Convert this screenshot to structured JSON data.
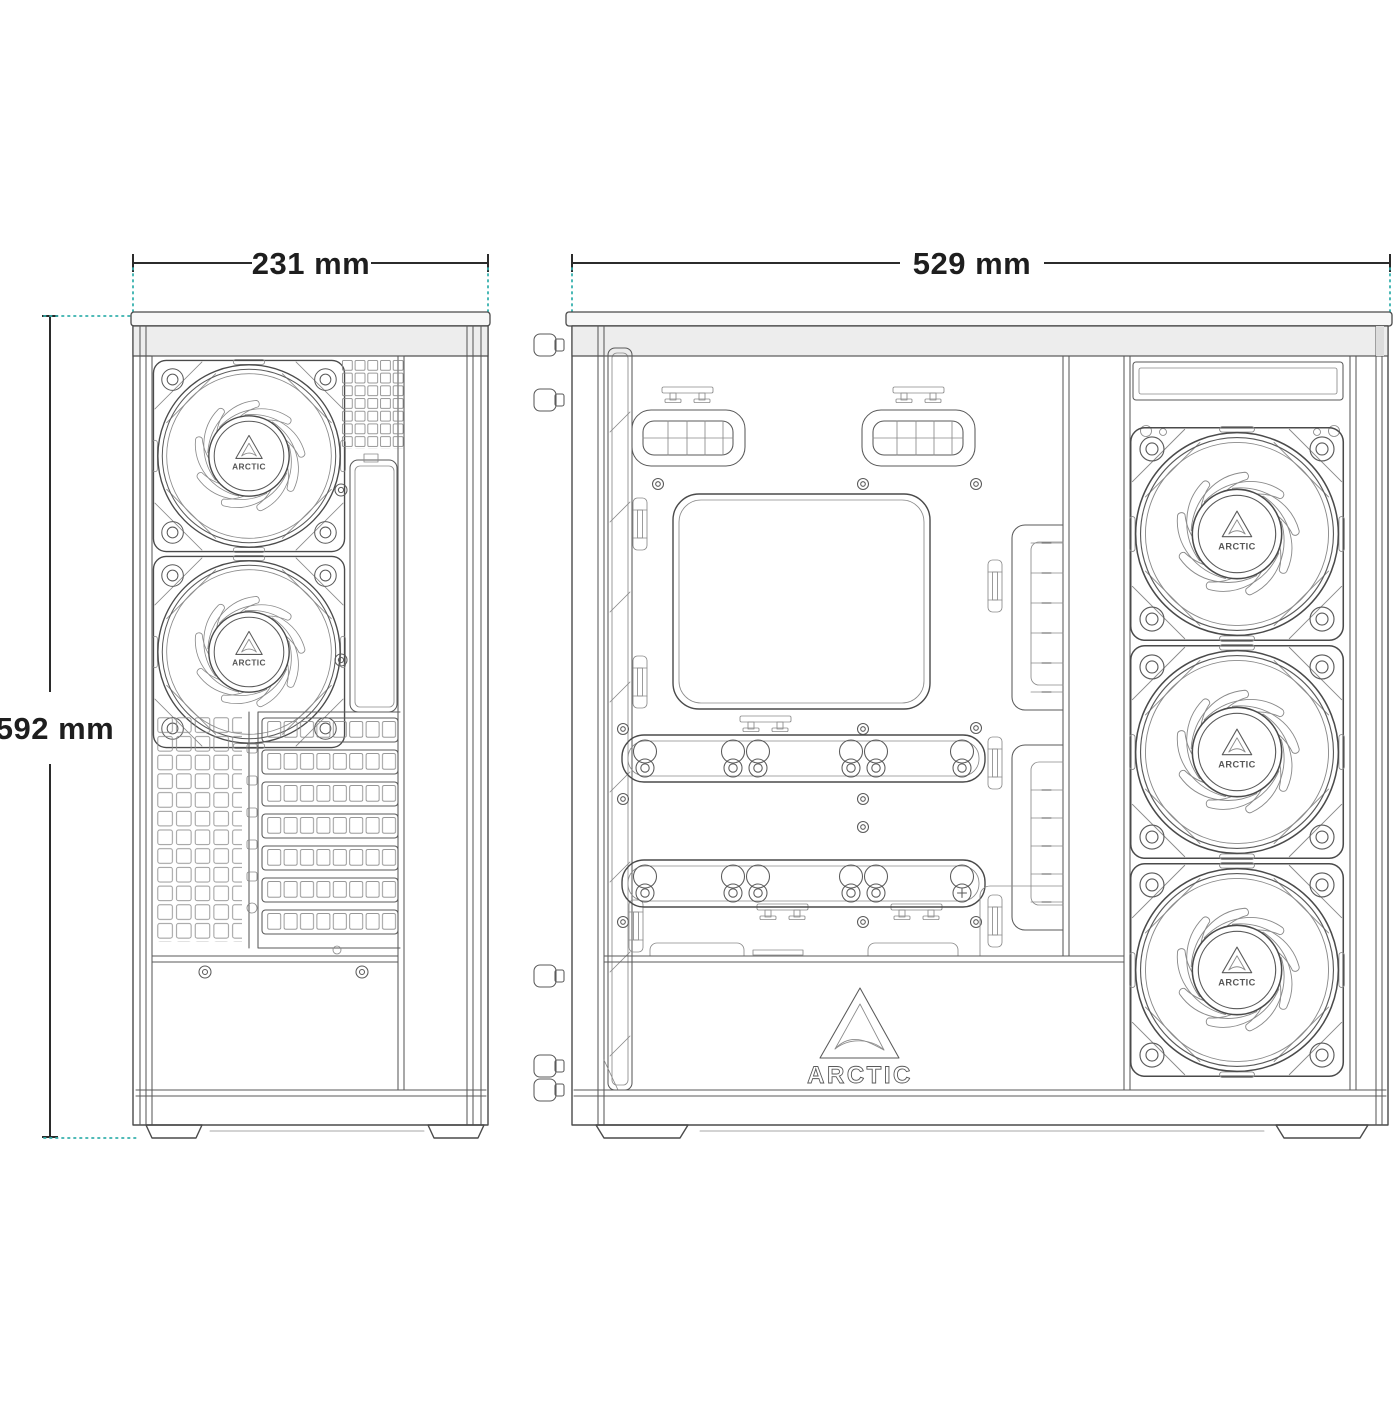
{
  "title": "ARCTIC PC case technical dimension drawing",
  "brand": {
    "name": "ARCTIC"
  },
  "dimensions": {
    "width": "231 mm",
    "height": "592 mm",
    "depth": "529 mm"
  },
  "views": {
    "rear": {
      "label": "rear panel view",
      "fans": 2,
      "expansion_slots": 7
    },
    "side": {
      "label": "side interior view",
      "fans": 3,
      "drive_rails": 2,
      "cable_grommets": 2
    }
  },
  "colors": {
    "line": "#4a4a4a",
    "dimension_line": "#2b2b2b",
    "extension_line": "#35b0ad",
    "background": "#ffffff"
  }
}
